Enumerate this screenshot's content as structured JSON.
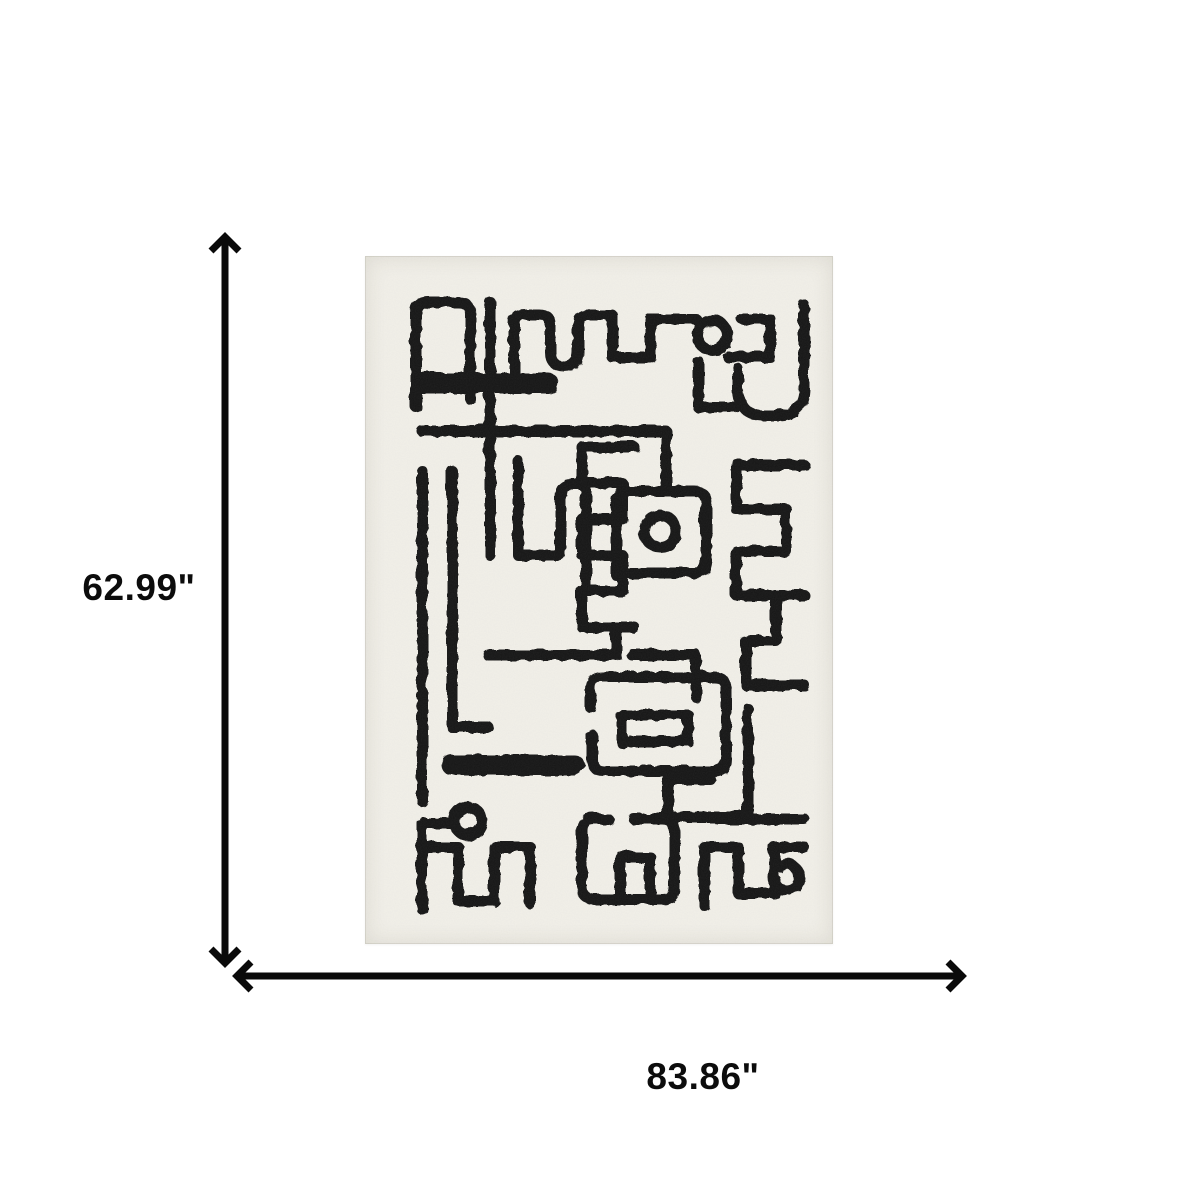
{
  "figure": {
    "type": "product-dimension-diagram",
    "vertical_dimension": {
      "label": "62.99\"",
      "value_inches": 62.99
    },
    "horizontal_dimension": {
      "label": "83.86\"",
      "value_inches": 83.86
    },
    "product": {
      "kind": "area-rug",
      "style": "abstract one-line black scribble art on ivory ground"
    },
    "colors": {
      "canvas_background": "#ffffff",
      "dimension_lines": "#0a0a0a",
      "label_color": "#0c0c0c",
      "rug_background": "#f1efe8",
      "rug_pattern": "#191919",
      "rug_edge": "#e3e0d8"
    }
  }
}
